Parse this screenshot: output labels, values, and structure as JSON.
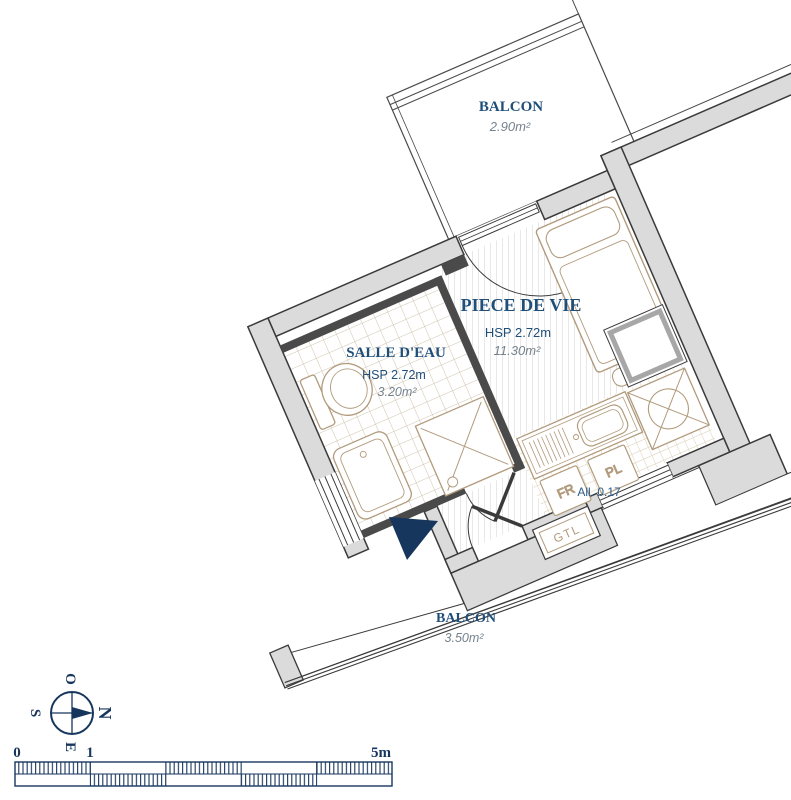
{
  "plan": {
    "rooms": [
      {
        "id": "balcon-top",
        "name": "BALCON",
        "area": "2.90m²"
      },
      {
        "id": "piece-de-vie",
        "name": "PIECE DE VIE",
        "ceiling": "HSP 2.72m",
        "area": "11.30m²"
      },
      {
        "id": "salle-deau",
        "name": "SALLE D'EAU",
        "ceiling": "HSP 2.72m",
        "area": "3.20m²"
      },
      {
        "id": "balcon-bottom",
        "name": "BALCON",
        "area": "3.50m²"
      }
    ],
    "labels": {
      "window_sill": "All. 0.17",
      "fridge": "FR",
      "closet": "PL",
      "gtl": "GTL"
    },
    "compass": {
      "north": "N",
      "east": "E",
      "south": "S",
      "west": "O"
    },
    "scale_bar": {
      "zero": "0",
      "one": "1",
      "five": "5m"
    },
    "colors": {
      "navy_text": "#1F4E79",
      "deep_navy": "#17365D",
      "tan": "#B29B7D",
      "wall_fill": "#DBDBDB",
      "wall_stroke": "#3A3A3A",
      "partition": "#4A4A4A",
      "area_text": "#75828E",
      "hatch_line": "#D2D2D2",
      "tile_bath": "#CFC2AE",
      "tile_kitchen": "#D8CAB2"
    }
  }
}
